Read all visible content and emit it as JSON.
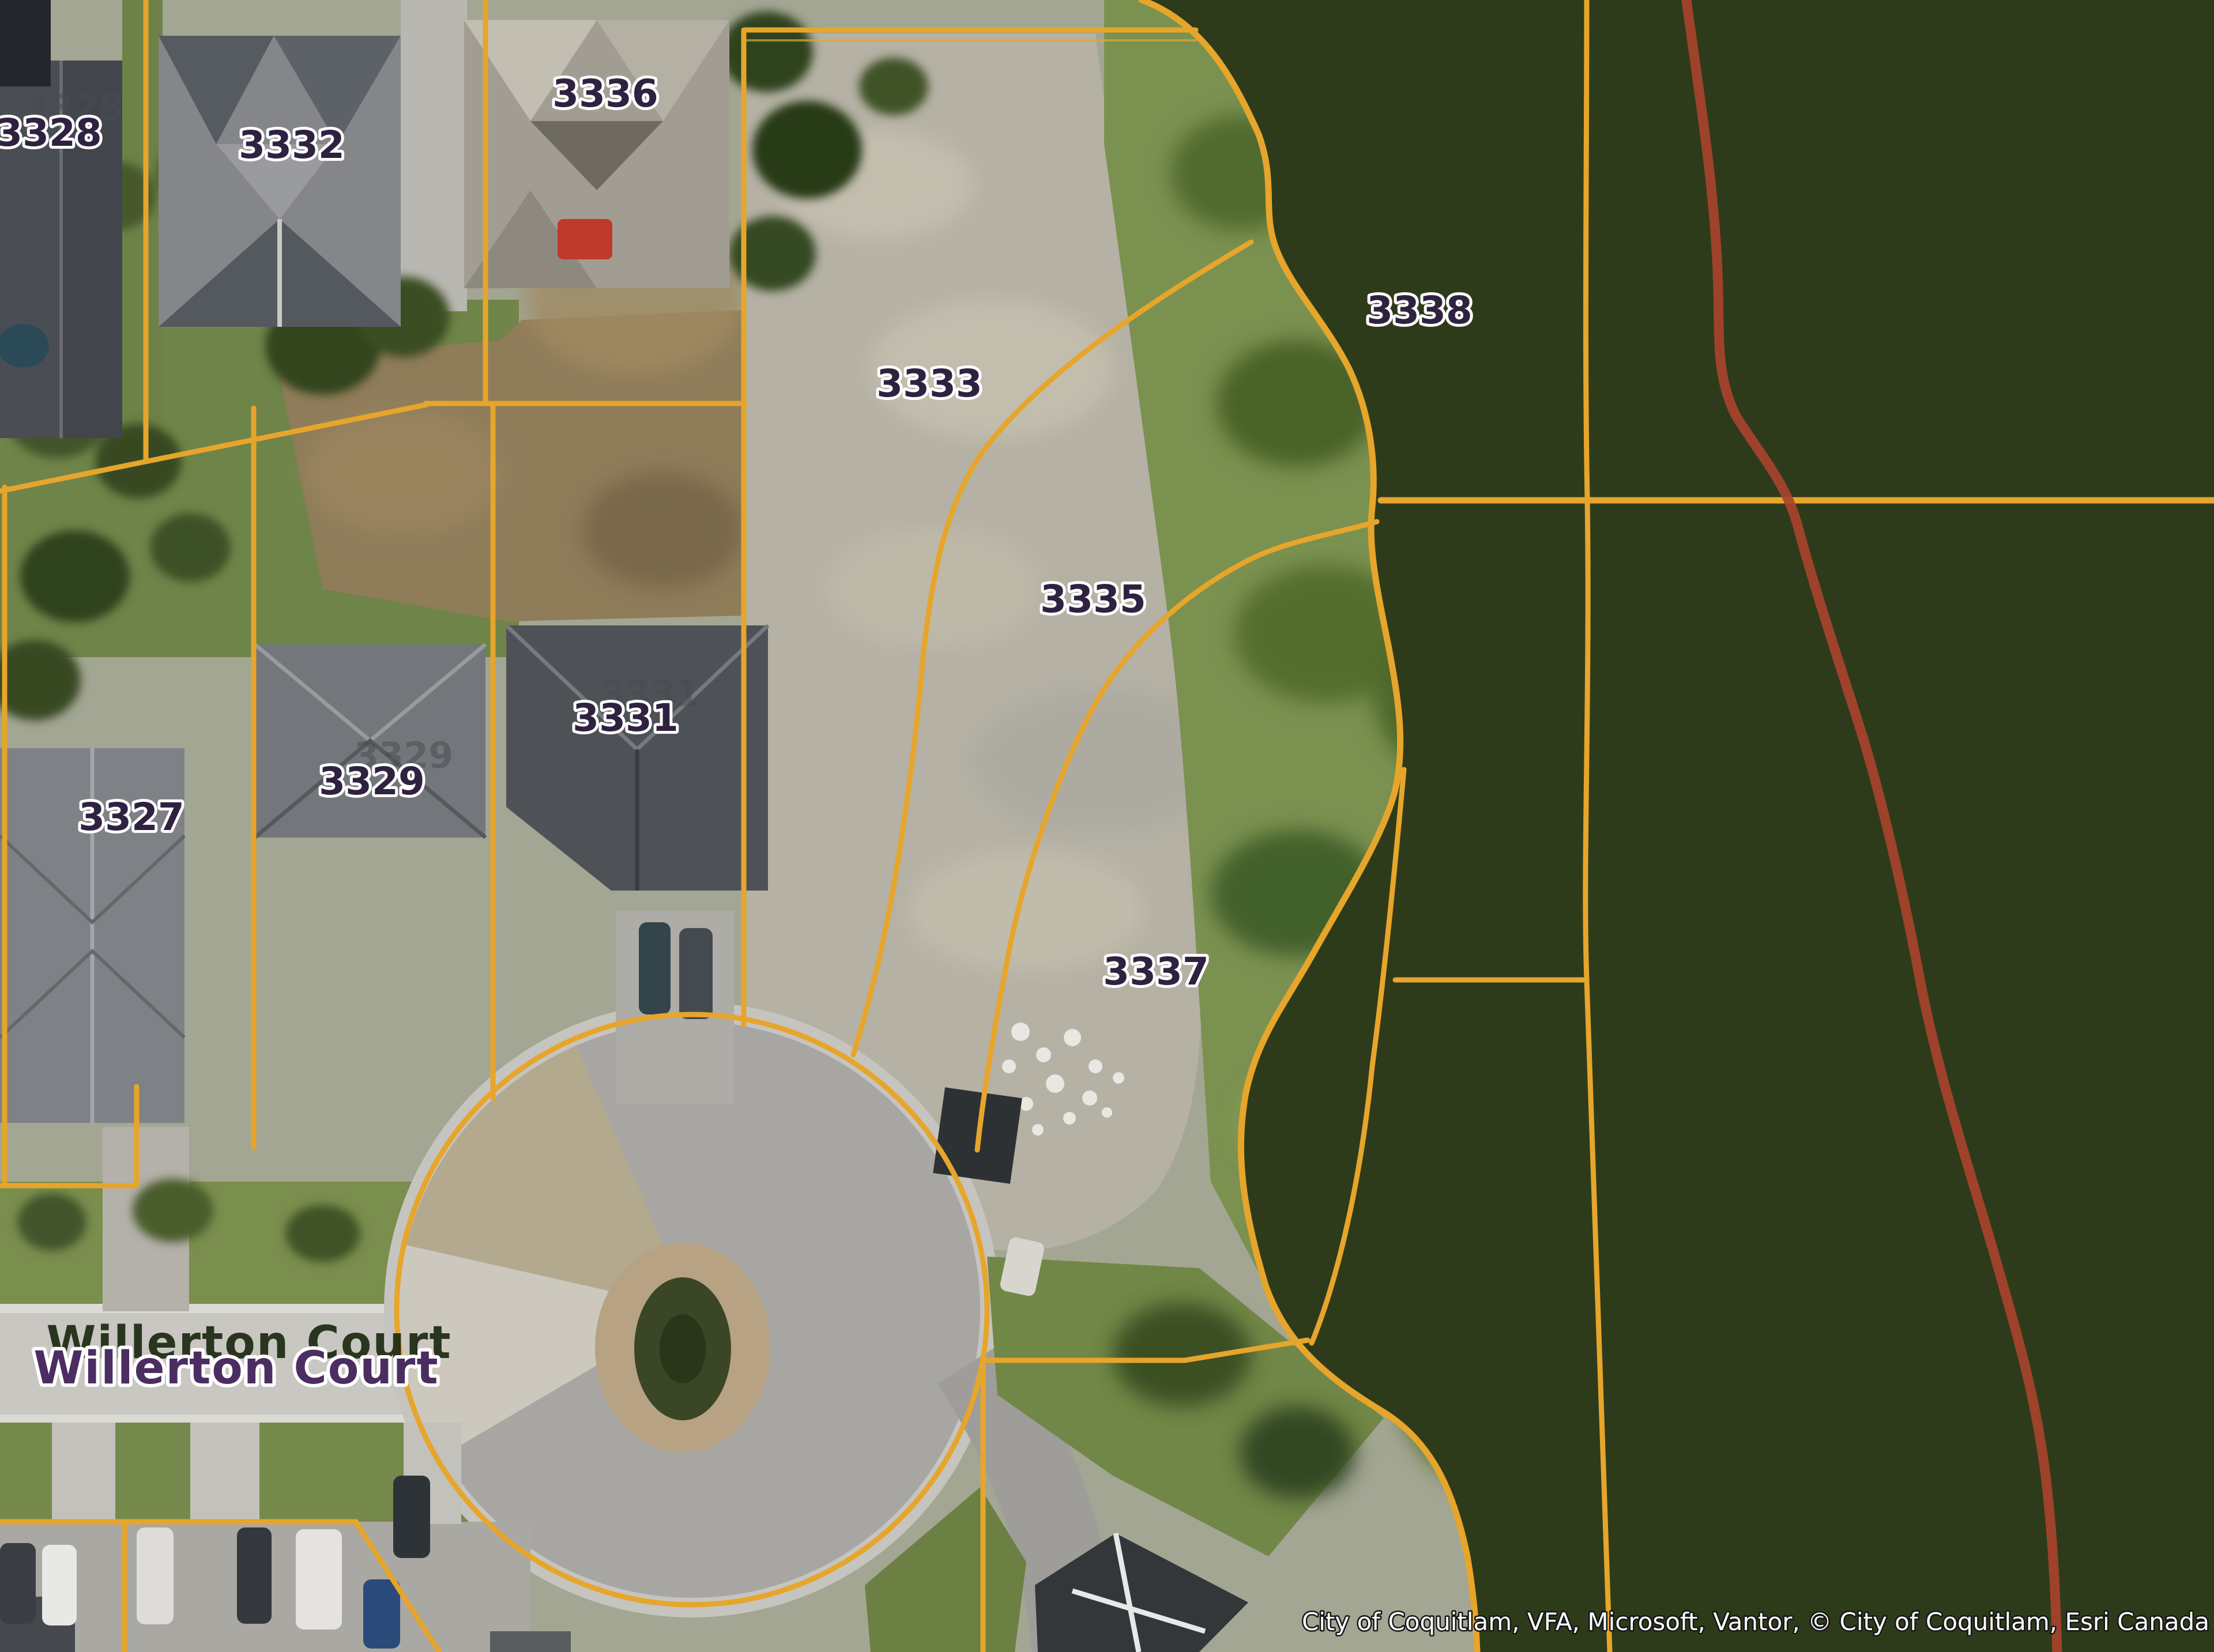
{
  "map": {
    "parcel_labels": [
      {
        "text": "3328"
      },
      {
        "text": "3332"
      },
      {
        "text": "3336"
      },
      {
        "text": "3333"
      },
      {
        "text": "3338"
      },
      {
        "text": "3335"
      },
      {
        "text": "3331"
      },
      {
        "text": "3329"
      },
      {
        "text": "3327"
      },
      {
        "text": "3337"
      }
    ],
    "ghost_labels": [
      {
        "text": "3328"
      },
      {
        "text": "3329"
      },
      {
        "text": "3331"
      }
    ],
    "street_label": {
      "text": "Willerton Court"
    },
    "attribution": {
      "text": "City of Coquitlam, VFA, Microsoft, Vantor, © City of Coquitlam, Esri Canada"
    },
    "colors": {
      "parcel_line": "#e6a52b",
      "trail_line": "#a8432c",
      "parcel_label": "#2f2140",
      "street_label": "#4b2d62",
      "label_halo": "#ffffff",
      "hatch_line": "#dde4a6"
    }
  }
}
